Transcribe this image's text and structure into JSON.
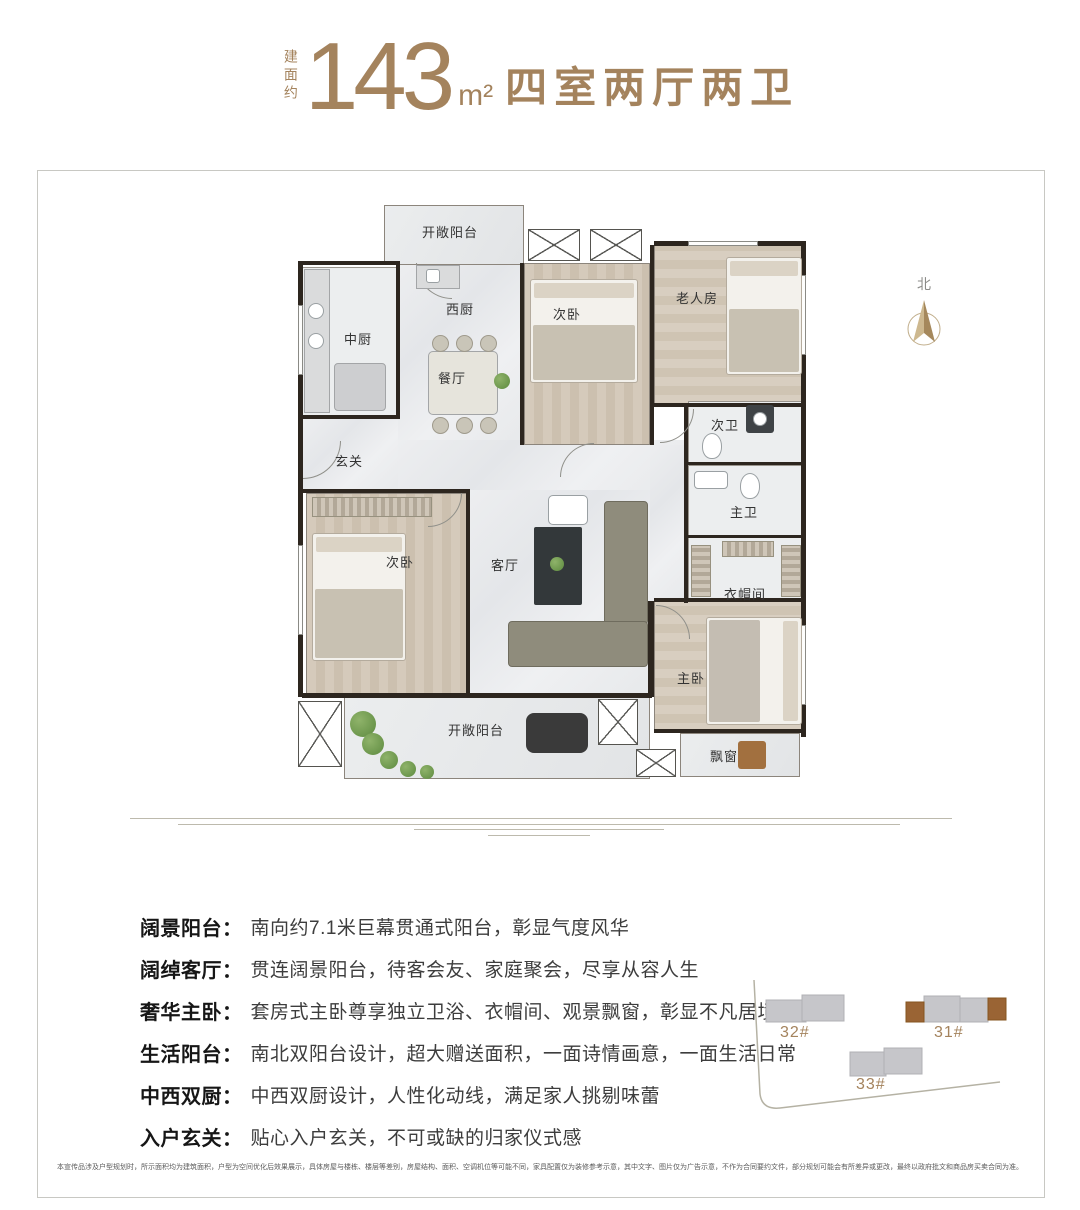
{
  "colors": {
    "accent": "#a4835d",
    "wall": "#2d261f",
    "building_highlight": "#9a6434"
  },
  "title": {
    "prefix_vertical": "建面约",
    "area": "143",
    "unit": "m²",
    "suffix": "四室两厅两卫"
  },
  "north_label": "北",
  "floorplan": {
    "rooms": [
      {
        "label": "开敞阳台"
      },
      {
        "label": "西厨"
      },
      {
        "label": "中厨"
      },
      {
        "label": "次卧"
      },
      {
        "label": "老人房"
      },
      {
        "label": "餐厅"
      },
      {
        "label": "次卫"
      },
      {
        "label": "玄关"
      },
      {
        "label": "主卫"
      },
      {
        "label": "次卧"
      },
      {
        "label": "客厅"
      },
      {
        "label": "衣帽间"
      },
      {
        "label": "主卧"
      },
      {
        "label": "飘窗"
      },
      {
        "label": "开敞阳台"
      }
    ]
  },
  "features": [
    {
      "name": "阔景阳台：",
      "desc": "南向约7.1米巨幕贯通式阳台，彰显气度风华"
    },
    {
      "name": "阔绰客厅：",
      "desc": "贯连阔景阳台，待客会友、家庭聚会，尽享从容人生"
    },
    {
      "name": "奢华主卧：",
      "desc": "套房式主卧尊享独立卫浴、衣帽间、观景飘窗，彰显不凡居境"
    },
    {
      "name": "生活阳台：",
      "desc": "南北双阳台设计，超大赠送面积，一面诗情画意，一面生活日常"
    },
    {
      "name": "中西双厨：",
      "desc": "中西双厨设计，人性化动线，满足家人挑剔味蕾"
    },
    {
      "name": "入户玄关：",
      "desc": "贴心入户玄关，不可或缺的归家仪式感"
    }
  ],
  "sitemap": {
    "buildings": [
      {
        "label": "32#"
      },
      {
        "label": "31#"
      },
      {
        "label": "33#"
      }
    ]
  },
  "disclaimer": "本宣传品涉及户型规划时，所示面积均为建筑面积，户型为空间优化后效果展示，具体房屋与楼栋、楼层等差别，房屋结构、面积、空调机位等可能不同，家具配置仅为装修参考示意，其中文字、图片仅为广告示意，不作为合同要约文件，部分规划可能会有所差异或更改，最终以政府批文和商品房买卖合同为准。"
}
